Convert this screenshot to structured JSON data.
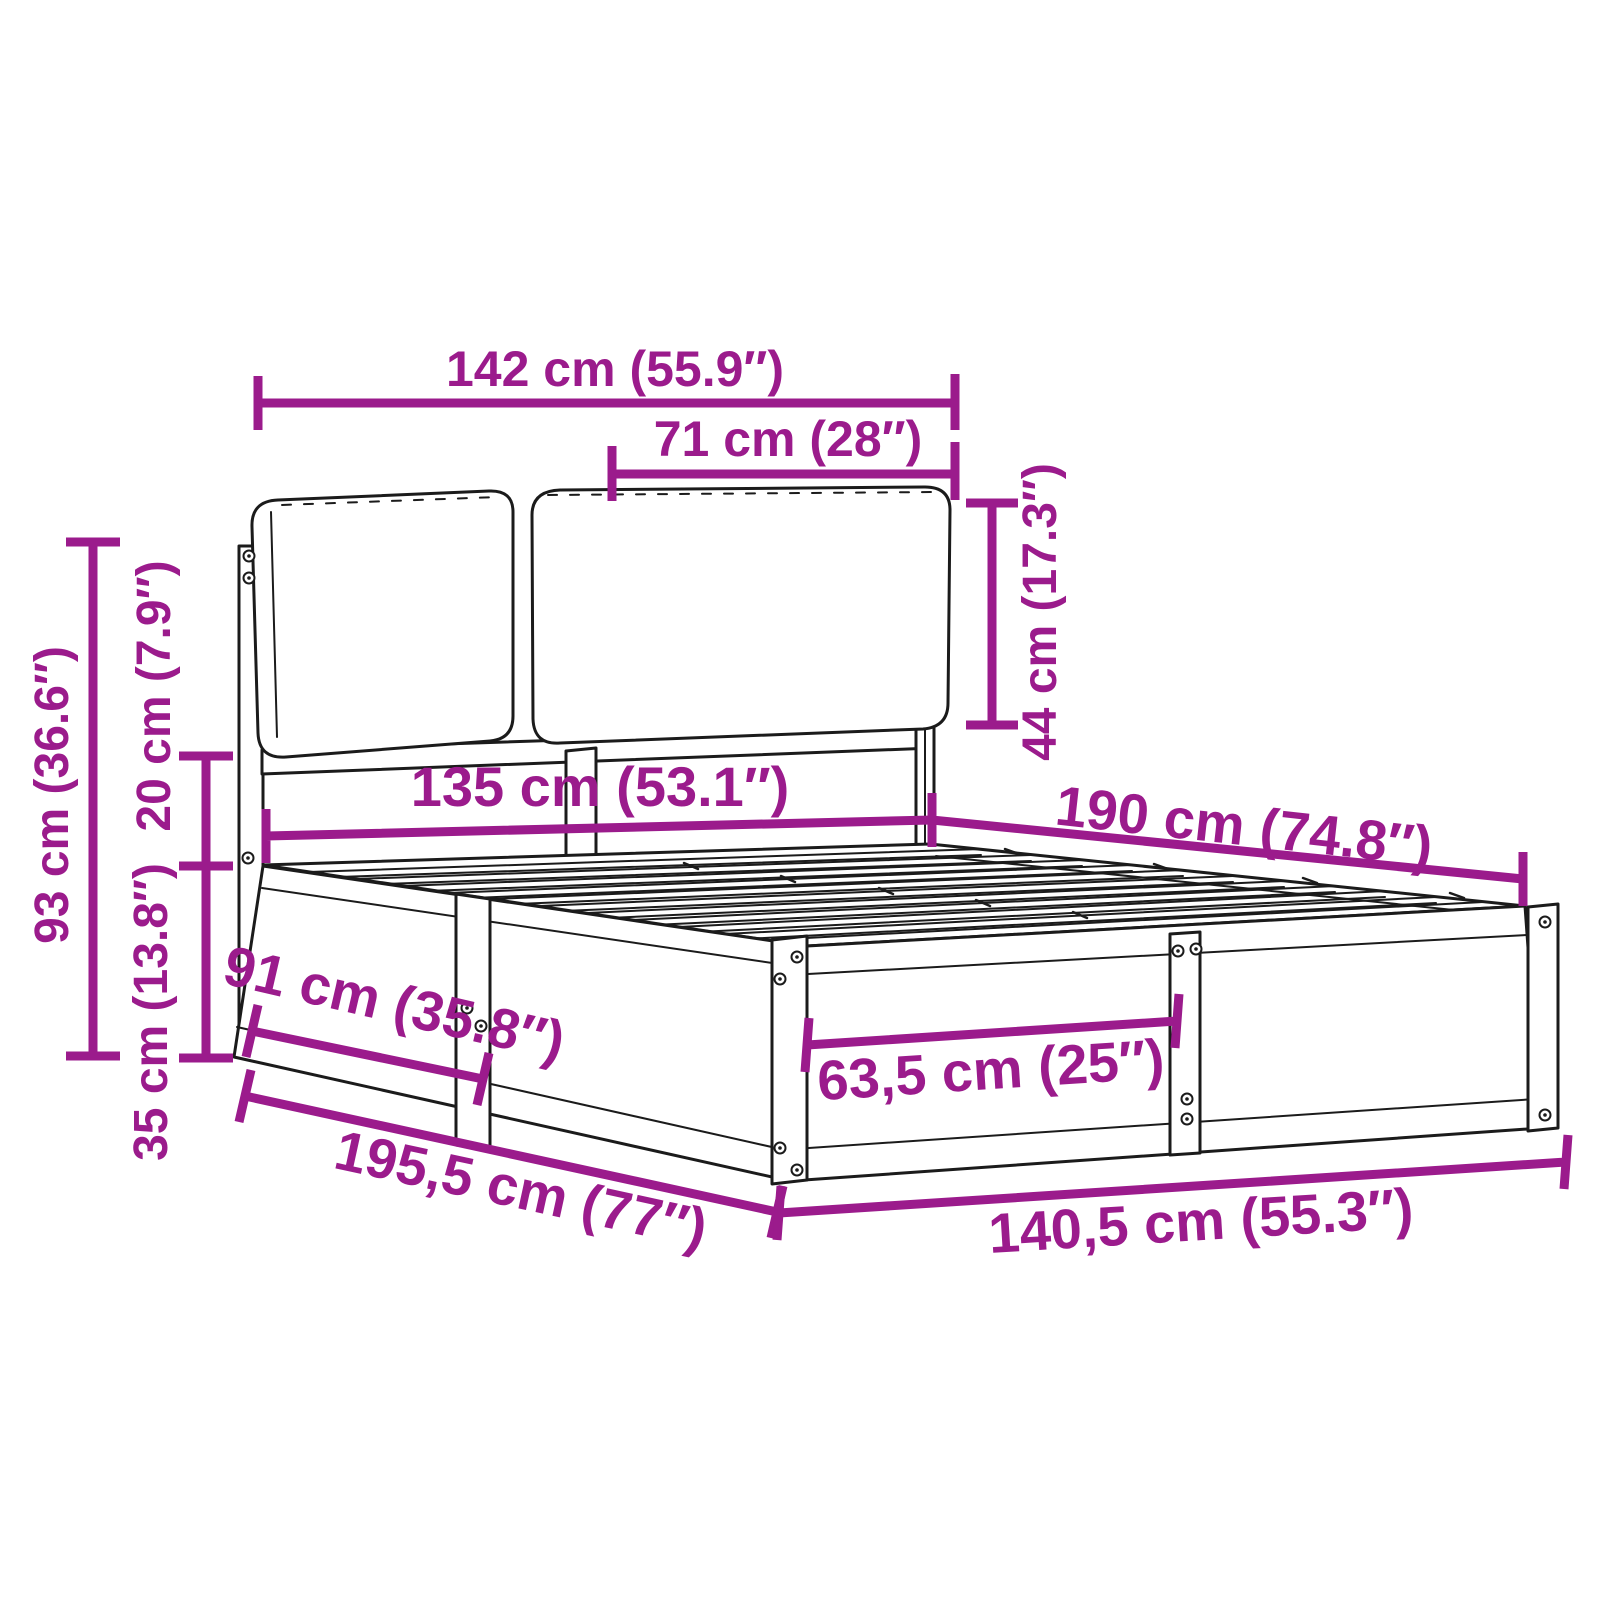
{
  "figure": {
    "type": "product-dimension-diagram",
    "subject": "bed frame with cushioned headboard and slatted base",
    "background": "#ffffff"
  },
  "colors": {
    "dimension_annotation": "#9B1B8C",
    "line_art": "#1b1b1b"
  },
  "dimensions": [
    {
      "id": "headboard-total-width",
      "label": "142 cm (55.9″)"
    },
    {
      "id": "cushion-width",
      "label": "71 cm (28″)"
    },
    {
      "id": "cushion-height",
      "label": "44 cm (17.3″)"
    },
    {
      "id": "headboard-height",
      "label": "93 cm (36.6″)"
    },
    {
      "id": "cushion-gap-height",
      "label": "20 cm (7.9″)"
    },
    {
      "id": "base-height",
      "label": "35 cm (13.8″)"
    },
    {
      "id": "inner-width",
      "label": "135 cm (53.1″)"
    },
    {
      "id": "inner-length",
      "label": "190 cm (74.8″)"
    },
    {
      "id": "side-leg-spacing",
      "label": "91 cm (35.8″)"
    },
    {
      "id": "foot-leg-spacing",
      "label": "63,5 cm (25″)"
    },
    {
      "id": "total-length",
      "label": "195,5 cm (77″)"
    },
    {
      "id": "total-width",
      "label": "140,5 cm (55.3″)"
    }
  ]
}
